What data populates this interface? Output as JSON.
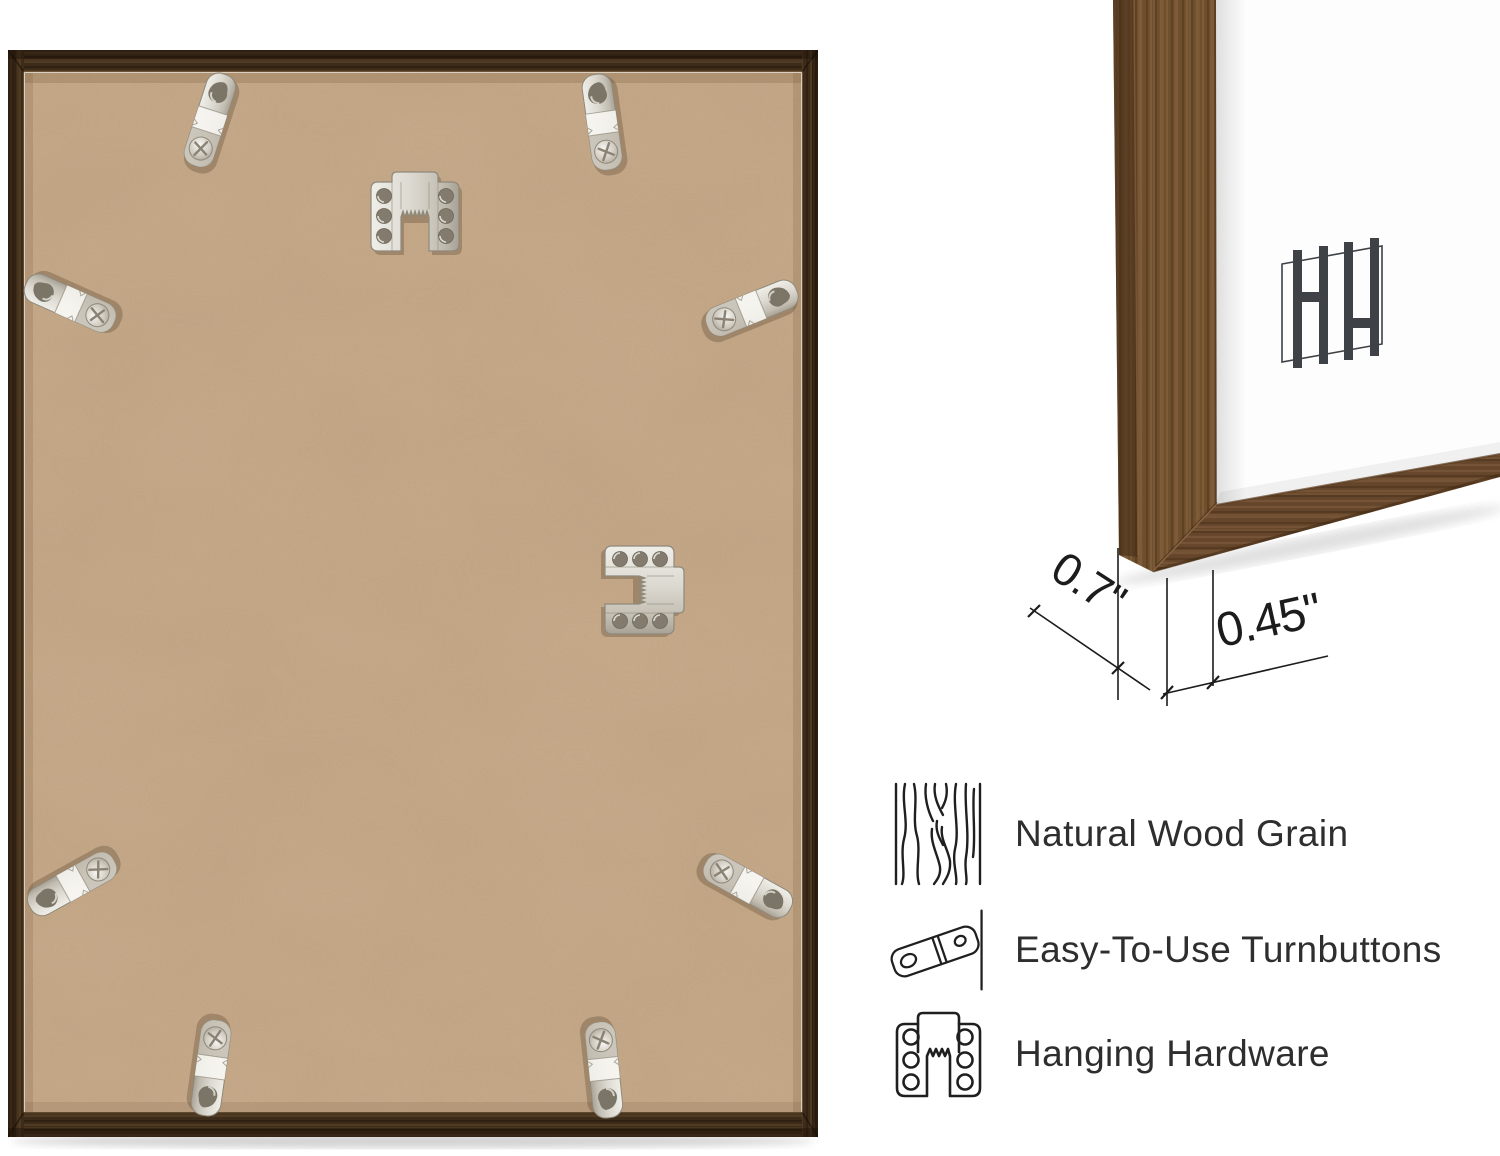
{
  "closeup": {
    "depth_label": "0.7\"",
    "face_width_label": "0.45\"",
    "brand_logo": "HH"
  },
  "features": [
    {
      "id": "wood-grain",
      "label": "Natural Wood Grain"
    },
    {
      "id": "turnbuttons",
      "label": "Easy-To-Use Turnbuttons"
    },
    {
      "id": "hanging-hardware",
      "label": "Hanging Hardware"
    }
  ],
  "back_view": {
    "turnbutton_count": 8,
    "sawtooth_hanger_count": 2
  },
  "colors": {
    "background": "#ffffff",
    "frame_wood_dark": "#3e2c1a",
    "frame_wood_mid": "#6f4e2d",
    "backing_board": "#c9ac8c",
    "metal_silver": "#d9d6cf",
    "annotation_ink": "#1c1c1c",
    "feature_text": "#2e2e2e",
    "logo_gray": "#3e4246"
  }
}
